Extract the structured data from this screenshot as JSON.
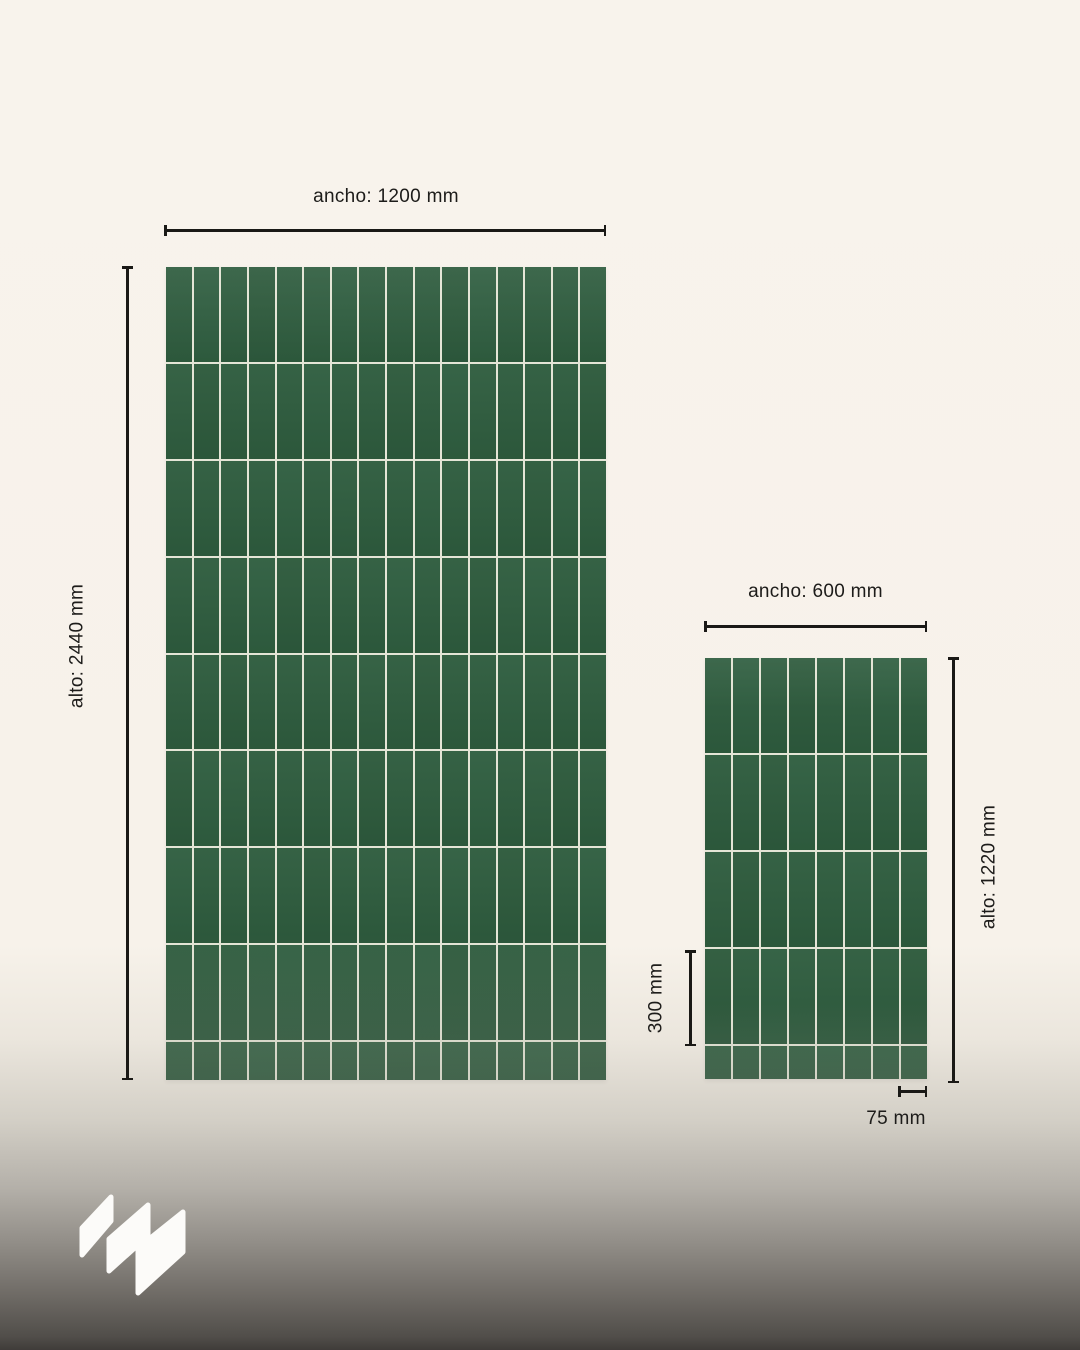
{
  "diagram": {
    "description_labels": {
      "width_prefix": "ancho",
      "height_prefix": "alto"
    }
  },
  "colors": {
    "background_cream": "#f8f3ec",
    "background_gradient_bottom": "#3f3c39",
    "tile_green": "#2e5c3e",
    "grout": "#e4e5d6",
    "dimension_line": "#1a1916",
    "text": "#1d1c1a",
    "logo_white": "#fcfbf9"
  },
  "panels": [
    {
      "id": "large",
      "width_label": "ancho: 1200 mm",
      "height_label": "alto: 2440 mm",
      "grid": {
        "columns": 16,
        "full_rows": 8,
        "partial_row_px": 38
      }
    },
    {
      "id": "small",
      "width_label": "ancho: 600 mm",
      "height_label": "alto: 1220 mm",
      "tile_height_label": "300 mm",
      "tile_width_label": "75 mm",
      "grid": {
        "columns": 8,
        "full_rows": 4,
        "partial_row_px": 33
      }
    }
  ],
  "logo": {
    "icon": "three-diagonal-parallelograms"
  }
}
